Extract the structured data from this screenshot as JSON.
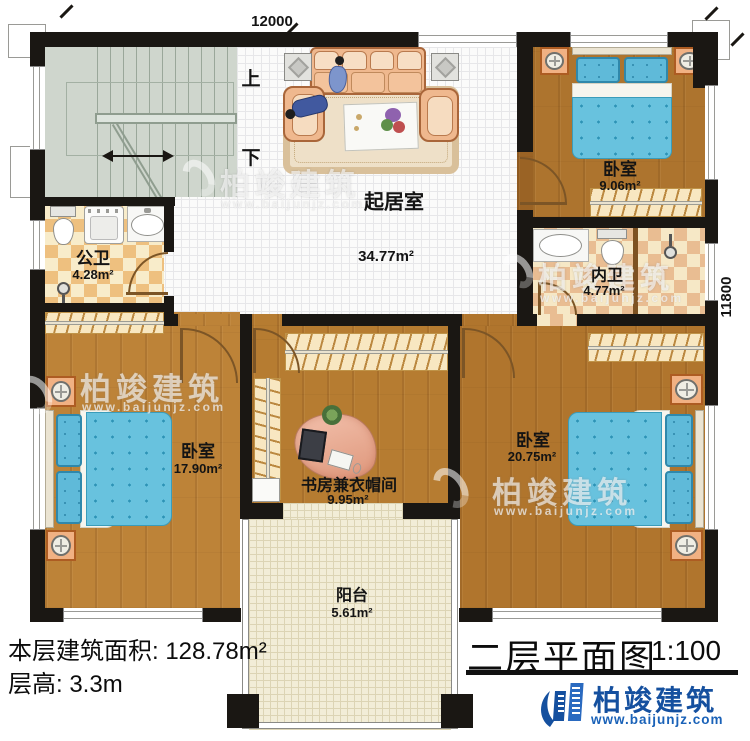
{
  "dimensions": {
    "top": "12000",
    "right": "11800"
  },
  "stairs": {
    "up": "上",
    "down": "下"
  },
  "rooms": {
    "living": {
      "name": "起居室",
      "area": "34.77m²"
    },
    "bedroom_top_right": {
      "name": "卧室",
      "area": "9.06m²"
    },
    "public_bath": {
      "name": "公卫",
      "area": "4.28m²"
    },
    "private_bath": {
      "name": "内卫",
      "area": "4.77m²"
    },
    "bedroom_left": {
      "name": "卧室",
      "area": "17.90m²"
    },
    "study": {
      "name": "书房兼衣帽间",
      "area": "9.95m²"
    },
    "bedroom_right": {
      "name": "卧室",
      "area": "20.75m²"
    },
    "balcony": {
      "name": "阳台",
      "area": "5.61m²"
    }
  },
  "footer": {
    "floor_area": "本层建筑面积: 128.78m²",
    "floor_height": "层高: 3.3m"
  },
  "title_block": {
    "title": "二层平面图",
    "scale": "1:100"
  },
  "brand": {
    "name": "柏竣建筑",
    "website": "www.baijunjz.com",
    "color": "#15509f"
  },
  "watermark": {
    "name": "柏竣建筑",
    "website": "www.baijunjz.com"
  },
  "icons": {
    "brand_logo": "building-swoosh",
    "watermark_logo": "swirl-ring"
  },
  "colors": {
    "wall": "#1a1713",
    "bed": "#68c2de",
    "wood": "#b5793a",
    "checker": "#eec07f",
    "stair": "#cfd6cd"
  }
}
